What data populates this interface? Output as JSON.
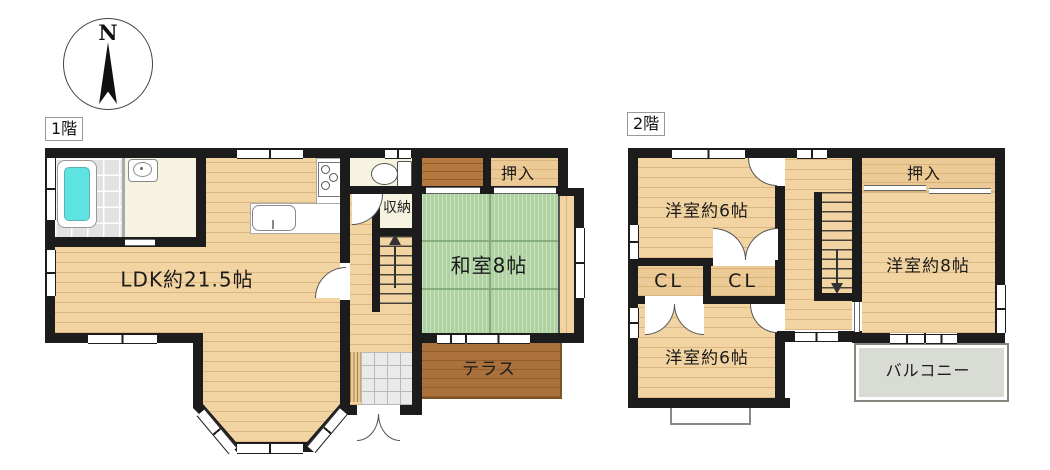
{
  "compass": {
    "north_label": "N"
  },
  "floor1": {
    "tag": "1階",
    "rooms": {
      "ldk": "LDK約21.5帖",
      "washitsu": "和室8帖",
      "oshiire": "押入",
      "shuno": "収納",
      "terrace": "テラス"
    }
  },
  "floor2": {
    "tag": "2階",
    "rooms": {
      "yoshitsu6_top": "洋室約6帖",
      "yoshitsu6_bottom": "洋室約6帖",
      "yoshitsu8": "洋室約8帖",
      "cl_left": "CL",
      "cl_right": "CL",
      "oshiire": "押入",
      "balcony": "バルコニー"
    }
  },
  "colors": {
    "wall": "#1c1c1c",
    "wood": "#f2d4a2",
    "closet": "#ecca96",
    "darkwood": "#b5793f",
    "tatami": "#aed2a2",
    "tile": "#e2e2e2",
    "cream": "#f6f3e0",
    "genkan": "#eaeaea",
    "terrace": "#aa713c",
    "balcony": "#d9dbd5",
    "tub": "#5fe3e1"
  }
}
